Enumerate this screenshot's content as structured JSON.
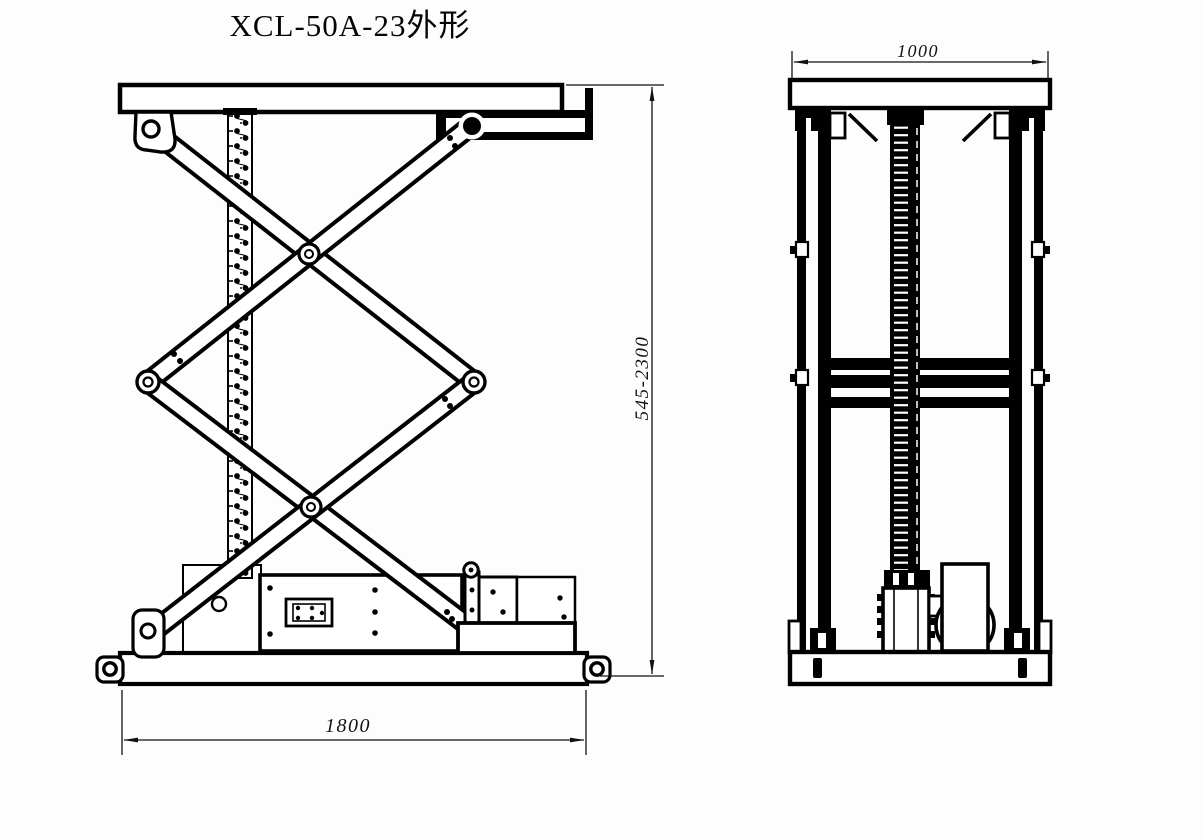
{
  "title": "XCL-50A-23外形",
  "side_view": {
    "label": "side-elevation",
    "width_dim": "1800",
    "height_dim": "545-2300"
  },
  "front_view": {
    "label": "end-elevation",
    "width_dim": "1000"
  },
  "colors": {
    "line": "#000000",
    "background": "#fdfdfd"
  }
}
